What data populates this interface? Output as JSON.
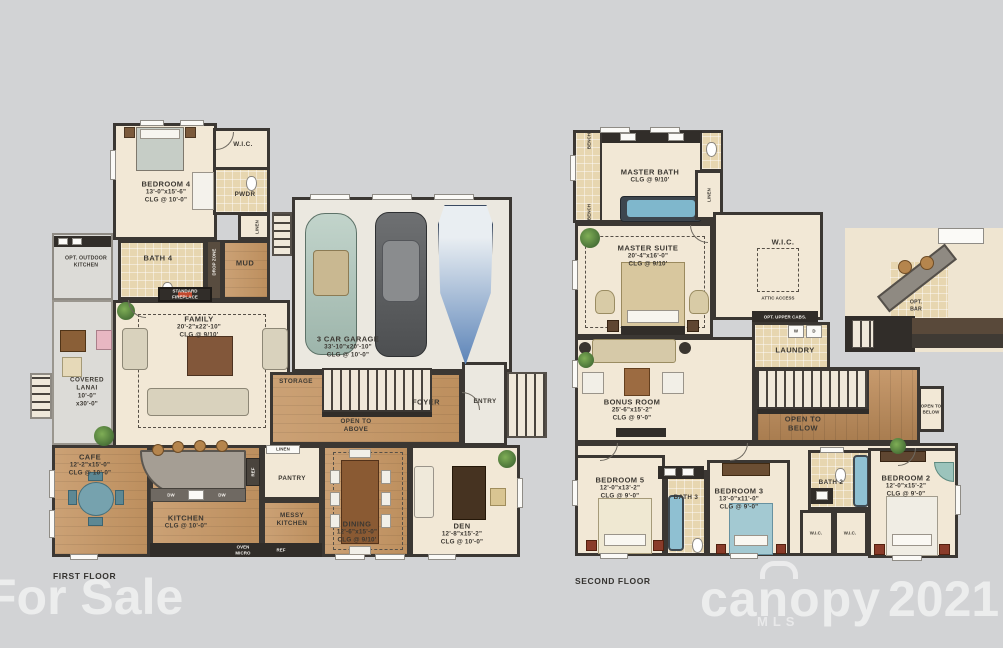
{
  "footer": {
    "first_floor": "FIRST FLOOR",
    "second_floor": "SECOND FLOOR"
  },
  "watermarks": {
    "for_sale": "For Sale",
    "brand": "canopy",
    "brand_sub": "MLS",
    "year": "2021"
  },
  "first_floor": {
    "bedroom4": {
      "label": "BEDROOM 4",
      "dims": "13'-0\"x15'-6\"",
      "clg": "CLG @ 10'-0\""
    },
    "wic": {
      "label": "W.I.C."
    },
    "pwdr": {
      "label": "PWDR"
    },
    "linen_hall": {
      "label": "LINEN"
    },
    "bath4": {
      "label": "BATH 4"
    },
    "mud": {
      "label": "MUD"
    },
    "drop_zone": {
      "label": "DROP ZONE"
    },
    "opt_outdoor_kitchen": {
      "label": "OPT. OUTDOOR KITCHEN"
    },
    "fireplace": {
      "label": "STANDARD FIREPLACE"
    },
    "family": {
      "label": "FAMILY",
      "dims": "20'-2\"x22'-10\"",
      "clg": "CLG @ 9/10'"
    },
    "garage": {
      "label": "3 CAR GARAGE",
      "dims": "33'-10\"x20'-10\"",
      "clg": "CLG @ 10'-0\""
    },
    "storage": {
      "label": "STORAGE"
    },
    "open_to_above": {
      "label": "OPEN TO ABOVE"
    },
    "foyer": {
      "label": "FOYER"
    },
    "entry": {
      "label": "ENTRY"
    },
    "covered_lanai": {
      "label": "COVERED LANAI",
      "dims": "10'-0\"",
      "dims2": "x30'-0\""
    },
    "cafe": {
      "label": "CAFE",
      "dims": "12'-2\"x15'-0\"",
      "clg": "CLG @ 10'-0\""
    },
    "kitchen": {
      "label": "KITCHEN",
      "clg": "CLG @ 10'-0\""
    },
    "pantry": {
      "label": "PANTRY"
    },
    "linen_pantry": {
      "label": "LINEN"
    },
    "messy_kitchen": {
      "label": "MESSY KITCHEN"
    },
    "dining": {
      "label": "DINING",
      "dims": "12'-6\"x15'-0\"",
      "clg": "CLG @ 9/10'"
    },
    "den": {
      "label": "DEN",
      "dims": "12'-8\"x15'-2\"",
      "clg": "CLG @ 10'-0\""
    },
    "appliances": {
      "dw": "DW",
      "dw2": "DW",
      "oven_micro": "OVEN MICRO",
      "ref": "REF",
      "ref_island": "REF"
    }
  },
  "second_floor": {
    "master_bath": {
      "label": "MASTER BATH",
      "clg": "CLG @ 9/10'"
    },
    "bench1": {
      "label": "BENCH"
    },
    "bench2": {
      "label": "BENCH"
    },
    "linen": {
      "label": "LINEN"
    },
    "master_suite": {
      "label": "MASTER SUITE",
      "dims": "20'-4\"x16'-0\"",
      "clg": "CLG @ 9/10'"
    },
    "wic": {
      "label": "W.I.C."
    },
    "attic_access": {
      "label": "ATTIC ACCESS"
    },
    "opt_upper_cabs": {
      "label": "OPT. UPPER CABS."
    },
    "washer": {
      "label": "W"
    },
    "dryer": {
      "label": "D"
    },
    "laundry": {
      "label": "LAUNDRY"
    },
    "bonus_room": {
      "label": "BONUS ROOM",
      "dims": "25'-6\"x15'-2\"",
      "clg": "CLG @ 9'-0\""
    },
    "open_to_below": {
      "label": "OPEN TO BELOW"
    },
    "open_to_below_small": {
      "label": "OPEN TO BELOW"
    },
    "bedroom5": {
      "label": "BEDROOM 5",
      "dims": "12'-0\"x13'-2\"",
      "clg": "CLG @ 9'-0\""
    },
    "bath3": {
      "label": "BATH 3"
    },
    "bedroom3": {
      "label": "BEDROOM 3",
      "dims": "13'-0\"x11'-0\"",
      "clg": "CLG @ 9'-0\""
    },
    "bath2": {
      "label": "BATH 2"
    },
    "wic1": {
      "label": "W.I.C."
    },
    "wic2": {
      "label": "W.I.C."
    },
    "bedroom2": {
      "label": "BEDROOM 2",
      "dims": "12'-0\"x15'-2\"",
      "clg": "CLG @ 9'-0\""
    },
    "opt_bar": {
      "label": "OPT. BAR"
    }
  }
}
